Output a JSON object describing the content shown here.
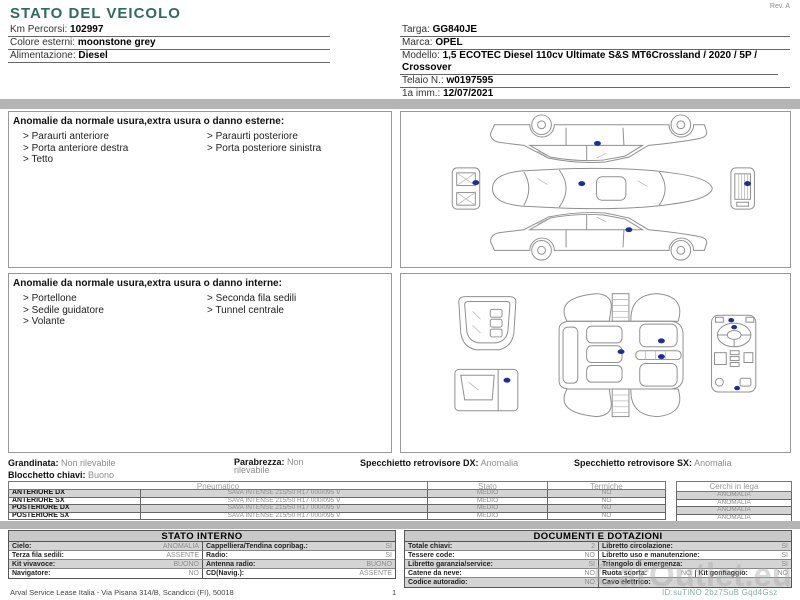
{
  "header": {
    "title": "STATO DEL VEICOLO",
    "rev": "Rev. A",
    "fields_left": [
      {
        "label": "Km Percorsi:",
        "value": "102997"
      },
      {
        "label": "Colore esterni:",
        "value": "moonstone grey"
      },
      {
        "label": "Alimentazione:",
        "value": "Diesel"
      }
    ],
    "fields_right": [
      {
        "label": "Targa:",
        "value": "GG840JE"
      },
      {
        "label": "Marca:",
        "value": "OPEL"
      },
      {
        "label": "Modello:",
        "value": "1,5 ECOTEC Diesel 110cv Ultimate S&S MT6Crossland / 2020 / 5P / Crossover"
      },
      {
        "label": "Telaio N.:",
        "value": "w0197595"
      },
      {
        "label": "1a imm.:",
        "value": "12/07/2021"
      }
    ]
  },
  "damage_exterior": {
    "heading": "Anomalie da normale usura,extra usura o danno esterne:",
    "items_col1": [
      "> Paraurti anteriore",
      "> Porta anteriore destra",
      "> Tetto"
    ],
    "items_col2": [
      "> Paraurti posteriore",
      "> Porta posteriore sinistra"
    ]
  },
  "damage_interior": {
    "heading": "Anomalie da normale usura,extra usura o danno interne:",
    "items_col1": [
      "> Portellone",
      "> Sedile guidatore",
      "> Volante"
    ],
    "items_col2": [
      "> Seconda fila sedili",
      "> Tunnel centrale"
    ]
  },
  "condition": {
    "grandinata_label": "Grandinata:",
    "grandinata_value": "Non rilevabile",
    "parabrezza_label": "Parabrezza:",
    "parabrezza_value": "Non rilevabile",
    "specchietto_dx_label": "Specchietto retrovisore DX:",
    "specchietto_dx_value": "Anomalia",
    "specchietto_sx_label": "Specchietto retrovisore SX:",
    "specchietto_sx_value": "Anomalia",
    "blocchetto_label": "Blocchetto chiavi:",
    "blocchetto_value": "Buono"
  },
  "tyres": {
    "headers": {
      "pneumatico": "Pneumatico",
      "stato": "Stato",
      "termiche": "Termiche",
      "cerchi": "Cerchi in lega"
    },
    "rows": [
      {
        "position": "ANTERIORE DX",
        "pneumatico": "SAVA INTENSE 215/50 R17 000/095 V",
        "stato": "MEDIO",
        "termiche": "NO",
        "cerchi": "ANOMALIA"
      },
      {
        "position": "ANTERIORE SX",
        "pneumatico": "SAVA INTENSE 215/50 R17 000/095 V",
        "stato": "MEDIO",
        "termiche": "NO",
        "cerchi": "ANOMALIA"
      },
      {
        "position": "POSTERIORE DX",
        "pneumatico": "SAVA INTENSE 215/50 R17 000/095 V",
        "stato": "MEDIO",
        "termiche": "NO",
        "cerchi": "ANOMALIA"
      },
      {
        "position": "POSTERIORE SX",
        "pneumatico": "SAVA INTENSE 215/50 R17 000/095 V",
        "stato": "MEDIO",
        "termiche": "NO",
        "cerchi": "ANOMALIA"
      }
    ]
  },
  "stato_interno": {
    "title": "STATO INTERNO",
    "rows": [
      {
        "l_label": "Cielo:",
        "l_value": "ANOMALIA",
        "r_label": "Cappelliera/Tendina copribag.:",
        "r_value": "SI"
      },
      {
        "l_label": "Terza fila sedili:",
        "l_value": "ASSENTE",
        "r_label": "Radio:",
        "r_value": "SI"
      },
      {
        "l_label": "Kit vivavoce:",
        "l_value": "BUONO",
        "r_label": "Antenna radio:",
        "r_value": "BUONO"
      },
      {
        "l_label": "Navigatore:",
        "l_value": "NO",
        "r_label": "CD(Navig.):",
        "r_value": "ASSENTE"
      }
    ]
  },
  "documenti": {
    "title": "DOCUMENTI E DOTAZIONI",
    "rows": [
      {
        "l_label": "Totale chiavi:",
        "l_value": "2",
        "r_label": "Libretto circolazione:",
        "r_value": "SI"
      },
      {
        "l_label": "Tessere code:",
        "l_value": "NO",
        "r_label": "Libretto uso e manutenzione:",
        "r_value": "SI"
      },
      {
        "l_label": "Libretto garanzia/service:",
        "l_value": "SI",
        "r_label": "Triangolo di emergenza:",
        "r_value": "SI"
      },
      {
        "l_label": "Catene da neve:",
        "l_value": "NO",
        "r_label": "Ruota scorta:",
        "r_value": "NO",
        "r2_label": "Kit gonfiaggio:",
        "r2_value": "NO"
      },
      {
        "l_label": "Codice autoradio:",
        "l_value": "NO",
        "r_label": "Cavo elettrico:",
        "r_value": ""
      }
    ]
  },
  "footer": {
    "company": "Arval Service Lease Italia - Via Pisana 314/B, Scandicci (FI), 50018",
    "page_number": "1",
    "watermark": "CarOutlet.eu",
    "doc_id": "ID:suTlNO 2bz7SuB Gqd4Gsz"
  },
  "colors": {
    "title_teal": "#2e6b5f",
    "damage_marker_blue": "#1b2f9c",
    "band_gray": "#b5b5b5",
    "row_alt_gray": "#d4d4d4",
    "header_bg_gray": "#c9c9c9"
  }
}
